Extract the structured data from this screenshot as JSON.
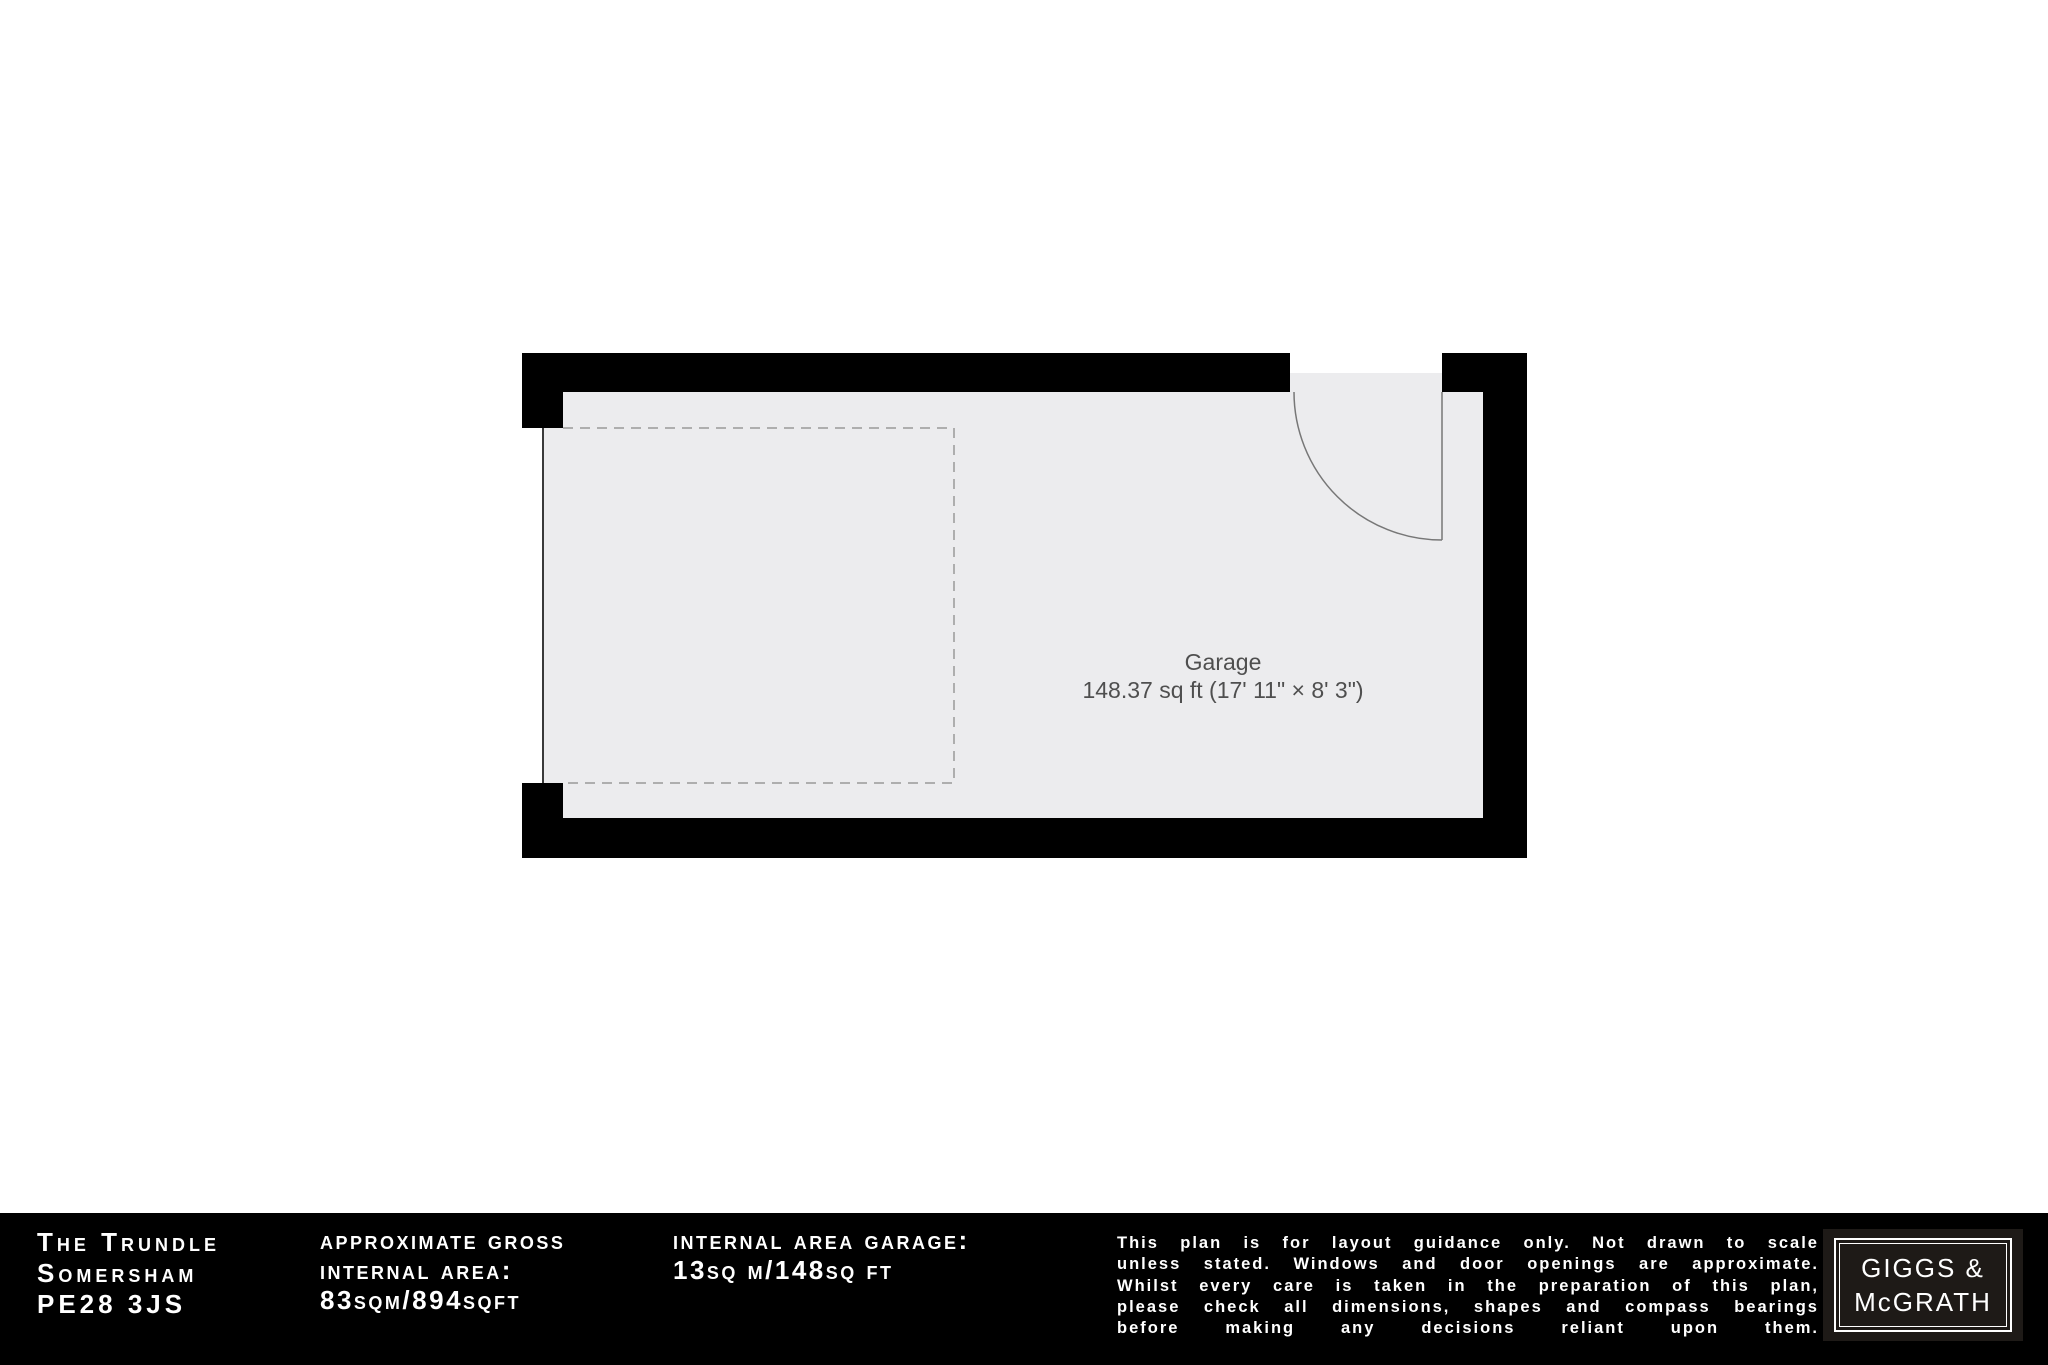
{
  "plan": {
    "room_label": "Garage",
    "room_area": "148.37 sq ft (17' 11\" × 8' 3\")",
    "colors": {
      "wall": "#000000",
      "floor": "#ececee",
      "door_line": "#777777",
      "garage_door_line": "#3a3a3a",
      "dashed_outline": "#999999",
      "label_text": "#4f4f4f"
    }
  },
  "footer": {
    "address_lines": [
      "The Trundle",
      "Somersham",
      "PE28 3JS"
    ],
    "gross_area_lines": [
      "approximate gross",
      "internal area:",
      "83sqm/894sqft"
    ],
    "garage_area_lines": [
      "internal area garage:",
      "13sq m/148sq ft"
    ],
    "disclaimer_lines": [
      "This plan is for layout guidance only. Not drawn to scale",
      "unless stated. Windows and door openings are approximate.",
      "Whilst every care is taken in the preparation of this plan,",
      "please check all dimensions, shapes and compass bearings",
      "before making any decisions reliant upon them."
    ],
    "logo_lines": [
      "GIGGS &",
      "McGRATH"
    ],
    "colors": {
      "bar_bg": "#000000",
      "logo_bg": "#1e1a17",
      "text": "#ffffff"
    }
  }
}
